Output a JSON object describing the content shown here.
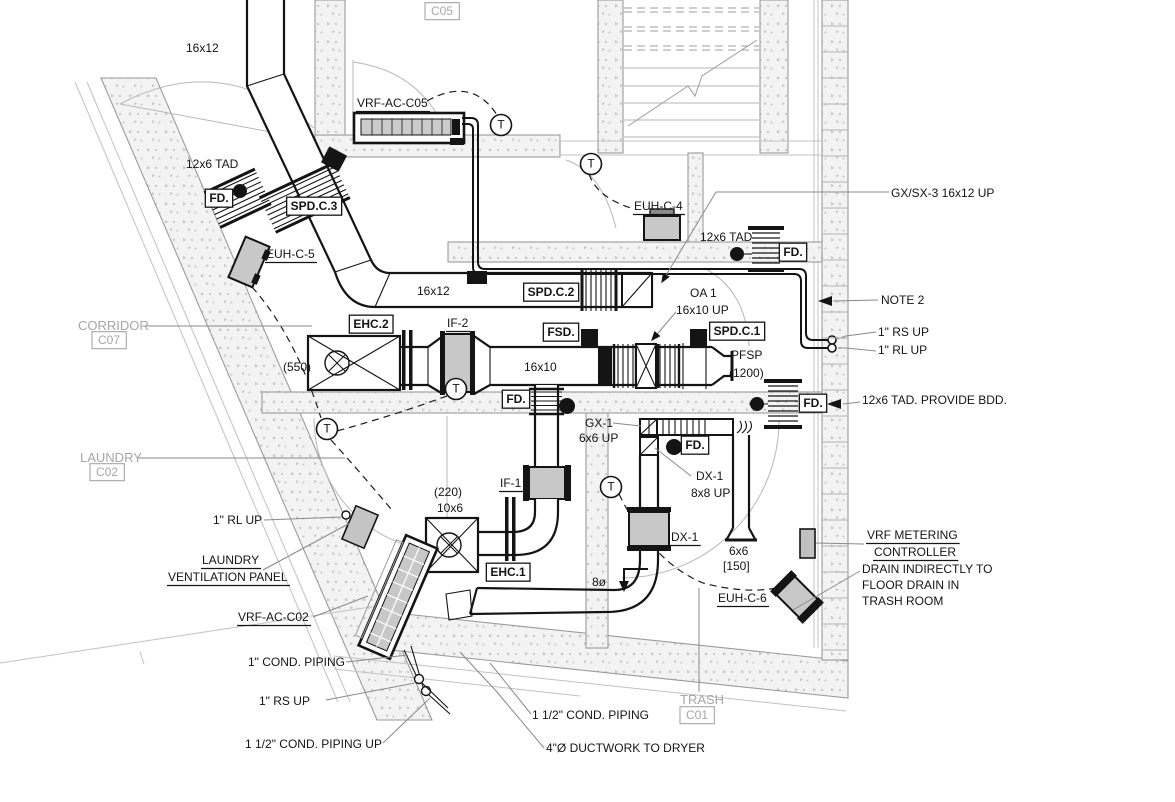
{
  "drawing": {
    "kind": "hvac-mechanical-floor-plan",
    "rooms": [
      {
        "name": "CORRIDOR",
        "tag": "C07"
      },
      {
        "name": "LAUNDRY",
        "tag": "C02"
      },
      {
        "name": "TRASH",
        "tag": "C01"
      },
      {
        "name": "",
        "tag": "C05"
      }
    ]
  },
  "colors": {
    "line": "#141414",
    "wall_stroke": "#9b9b9b",
    "speckle": "#c6c6c6",
    "room_text": "#a6a6a6",
    "equipment_fill": "#c8c8c8",
    "leader": "#8a8a8a"
  },
  "symbols": {
    "thermostat_letter": "T"
  },
  "thermostats": [
    {
      "x": 501,
      "y": 125
    },
    {
      "x": 591,
      "y": 164
    },
    {
      "x": 327,
      "y": 429
    },
    {
      "x": 456,
      "y": 389
    },
    {
      "x": 611,
      "y": 487
    }
  ],
  "labels": [
    {
      "id": "room-tag-c05",
      "kind": "tag",
      "text": "C05",
      "x": 442,
      "y": 12
    },
    {
      "id": "duct-16x12-top",
      "kind": "plain",
      "text": "16x12",
      "x": 186,
      "y": 52
    },
    {
      "id": "vrf-ac-c05",
      "kind": "underline",
      "text": "VRF-AC-C05",
      "x": 357,
      "y": 107
    },
    {
      "id": "tad-12x6-left",
      "kind": "plain",
      "text": "12x6 TAD",
      "x": 186,
      "y": 168
    },
    {
      "id": "fd-upper-left",
      "kind": "box",
      "text": "FD.",
      "x": 219,
      "y": 199
    },
    {
      "id": "spd-c3",
      "kind": "box",
      "text": "SPD.C.3",
      "x": 314,
      "y": 207
    },
    {
      "id": "euh-c5",
      "kind": "underline",
      "text": "EUH-C-5",
      "x": 266,
      "y": 258
    },
    {
      "id": "euh-c4",
      "kind": "underline",
      "text": "EUH-C-4",
      "x": 634,
      "y": 210
    },
    {
      "id": "gx-sx-3",
      "kind": "plain",
      "text": "GX/SX-3 16x12 UP",
      "x": 891,
      "y": 197
    },
    {
      "id": "tad-12x6-right",
      "kind": "plain",
      "text": "12x6 TAD",
      "x": 700,
      "y": 241
    },
    {
      "id": "fd-upper-right",
      "kind": "box",
      "text": "FD.",
      "x": 793,
      "y": 253
    },
    {
      "id": "duct-16x12-mid",
      "kind": "plain",
      "text": "16x12",
      "x": 417,
      "y": 295
    },
    {
      "id": "spd-c2",
      "kind": "box",
      "text": "SPD.C.2",
      "x": 551,
      "y": 293
    },
    {
      "id": "oa-1",
      "kind": "plain",
      "text": "OA 1",
      "x": 690,
      "y": 297
    },
    {
      "id": "oa-1-size",
      "kind": "plain",
      "text": "16x10 UP",
      "x": 676,
      "y": 314
    },
    {
      "id": "note-2",
      "kind": "plain",
      "text": "NOTE 2",
      "x": 881,
      "y": 304
    },
    {
      "id": "rs-up-right",
      "kind": "plain",
      "text": "1\" RS  UP",
      "x": 878,
      "y": 336
    },
    {
      "id": "rl-up-right",
      "kind": "plain",
      "text": "1\" RL  UP",
      "x": 878,
      "y": 354
    },
    {
      "id": "room-corridor",
      "kind": "room",
      "text": "CORRIDOR",
      "x": 78,
      "y": 330
    },
    {
      "id": "room-tag-c07",
      "kind": "tag",
      "text": "C07",
      "x": 109,
      "y": 341
    },
    {
      "id": "ehc-2",
      "kind": "box",
      "text": "EHC.2",
      "x": 371,
      "y": 325
    },
    {
      "id": "if-2",
      "kind": "underline",
      "text": "IF-2",
      "x": 447,
      "y": 327
    },
    {
      "id": "fsd",
      "kind": "box",
      "text": "FSD.",
      "x": 561,
      "y": 333
    },
    {
      "id": "spd-c1",
      "kind": "box",
      "text": "SPD.C.1",
      "x": 737,
      "y": 332
    },
    {
      "id": "cfm-550",
      "kind": "plain",
      "text": "(550)",
      "x": 283,
      "y": 371
    },
    {
      "id": "duct-16x10",
      "kind": "plain",
      "text": "16x10",
      "x": 524,
      "y": 371
    },
    {
      "id": "pfsp",
      "kind": "plain",
      "text": "PFSP",
      "x": 731,
      "y": 359
    },
    {
      "id": "pfsp-cfm",
      "kind": "plain",
      "text": "(1200)",
      "x": 729,
      "y": 377
    },
    {
      "id": "fd-mid",
      "kind": "box",
      "text": "FD.",
      "x": 516,
      "y": 400
    },
    {
      "id": "fd-right-wall",
      "kind": "box",
      "text": "FD.",
      "x": 813,
      "y": 404
    },
    {
      "id": "tad-bdd",
      "kind": "plain",
      "text": "12x6 TAD. PROVIDE BDD.",
      "x": 862,
      "y": 404
    },
    {
      "id": "room-laundry",
      "kind": "room",
      "text": "LAUNDRY",
      "x": 80,
      "y": 462
    },
    {
      "id": "room-tag-c02",
      "kind": "tag",
      "text": "C02",
      "x": 107,
      "y": 473
    },
    {
      "id": "gx-1",
      "kind": "plain",
      "text": "GX-1",
      "x": 585,
      "y": 427
    },
    {
      "id": "gx-1-size",
      "kind": "plain",
      "text": "6x6 UP",
      "x": 579,
      "y": 442
    },
    {
      "id": "fd-trash",
      "kind": "box",
      "text": "FD.",
      "x": 695,
      "y": 446
    },
    {
      "id": "dx-1-riser",
      "kind": "plain",
      "text": "DX-1",
      "x": 696,
      "y": 480
    },
    {
      "id": "dx-1-riser-size",
      "kind": "plain",
      "text": "8x8 UP",
      "x": 691,
      "y": 497
    },
    {
      "id": "cfm-220",
      "kind": "plain",
      "text": "(220)",
      "x": 434,
      "y": 496
    },
    {
      "id": "size-10x6",
      "kind": "plain",
      "text": "10x6",
      "x": 437,
      "y": 512
    },
    {
      "id": "if-1",
      "kind": "underline",
      "text": "IF-1",
      "x": 500,
      "y": 487
    },
    {
      "id": "dx-1",
      "kind": "underline",
      "text": "DX-1",
      "x": 671,
      "y": 541
    },
    {
      "id": "size-6x6",
      "kind": "plain",
      "text": "6x6",
      "x": 729,
      "y": 555
    },
    {
      "id": "size-150",
      "kind": "plain",
      "text": "[150]",
      "x": 723,
      "y": 570
    },
    {
      "id": "vrf-metering-1",
      "kind": "underline",
      "text": "VRF METERING",
      "x": 867,
      "y": 539
    },
    {
      "id": "vrf-metering-2",
      "kind": "underline",
      "text": "CONTROLLER",
      "x": 874,
      "y": 556
    },
    {
      "id": "rl-up-laundry",
      "kind": "plain",
      "text": "1\" RL  UP",
      "x": 213,
      "y": 524
    },
    {
      "id": "laundry-panel-1",
      "kind": "underline",
      "text": "LAUNDRY",
      "x": 202,
      "y": 564
    },
    {
      "id": "laundry-panel-2",
      "kind": "underline",
      "text": "VENTILATION PANEL",
      "x": 168,
      "y": 581
    },
    {
      "id": "drain-1",
      "kind": "plain",
      "text": "DRAIN INDIRECTLY TO",
      "x": 862,
      "y": 573
    },
    {
      "id": "drain-2",
      "kind": "plain",
      "text": "FLOOR DRAIN IN",
      "x": 862,
      "y": 589
    },
    {
      "id": "drain-3",
      "kind": "plain",
      "text": "TRASH ROOM",
      "x": 862,
      "y": 605
    },
    {
      "id": "ehc-1",
      "kind": "box",
      "text": "EHC.1",
      "x": 508,
      "y": 573
    },
    {
      "id": "size-8dia",
      "kind": "plain",
      "text": "8ø",
      "x": 592,
      "y": 586
    },
    {
      "id": "euh-c6",
      "kind": "underline",
      "text": "EUH-C-6",
      "x": 718,
      "y": 602
    },
    {
      "id": "vrf-ac-c02",
      "kind": "underline",
      "text": "VRF-AC-C02",
      "x": 238,
      "y": 621
    },
    {
      "id": "cond-1in",
      "kind": "plain",
      "text": "1\" COND. PIPING",
      "x": 248,
      "y": 666
    },
    {
      "id": "rs-up-bottom",
      "kind": "plain",
      "text": "1\" RS  UP",
      "x": 259,
      "y": 705
    },
    {
      "id": "cond-1half",
      "kind": "plain",
      "text": "1 1/2\" COND. PIPING",
      "x": 532,
      "y": 719
    },
    {
      "id": "room-trash",
      "kind": "room",
      "text": "TRASH",
      "x": 680,
      "y": 704
    },
    {
      "id": "room-tag-c01",
      "kind": "tag",
      "text": "C01",
      "x": 697,
      "y": 716
    },
    {
      "id": "cond-1half-up",
      "kind": "plain",
      "text": "1 1/2\" COND. PIPING  UP",
      "x": 245,
      "y": 748
    },
    {
      "id": "dryer-duct",
      "kind": "plain",
      "text": "4\"Ø DUCTWORK TO DRYER",
      "x": 546,
      "y": 752
    }
  ]
}
